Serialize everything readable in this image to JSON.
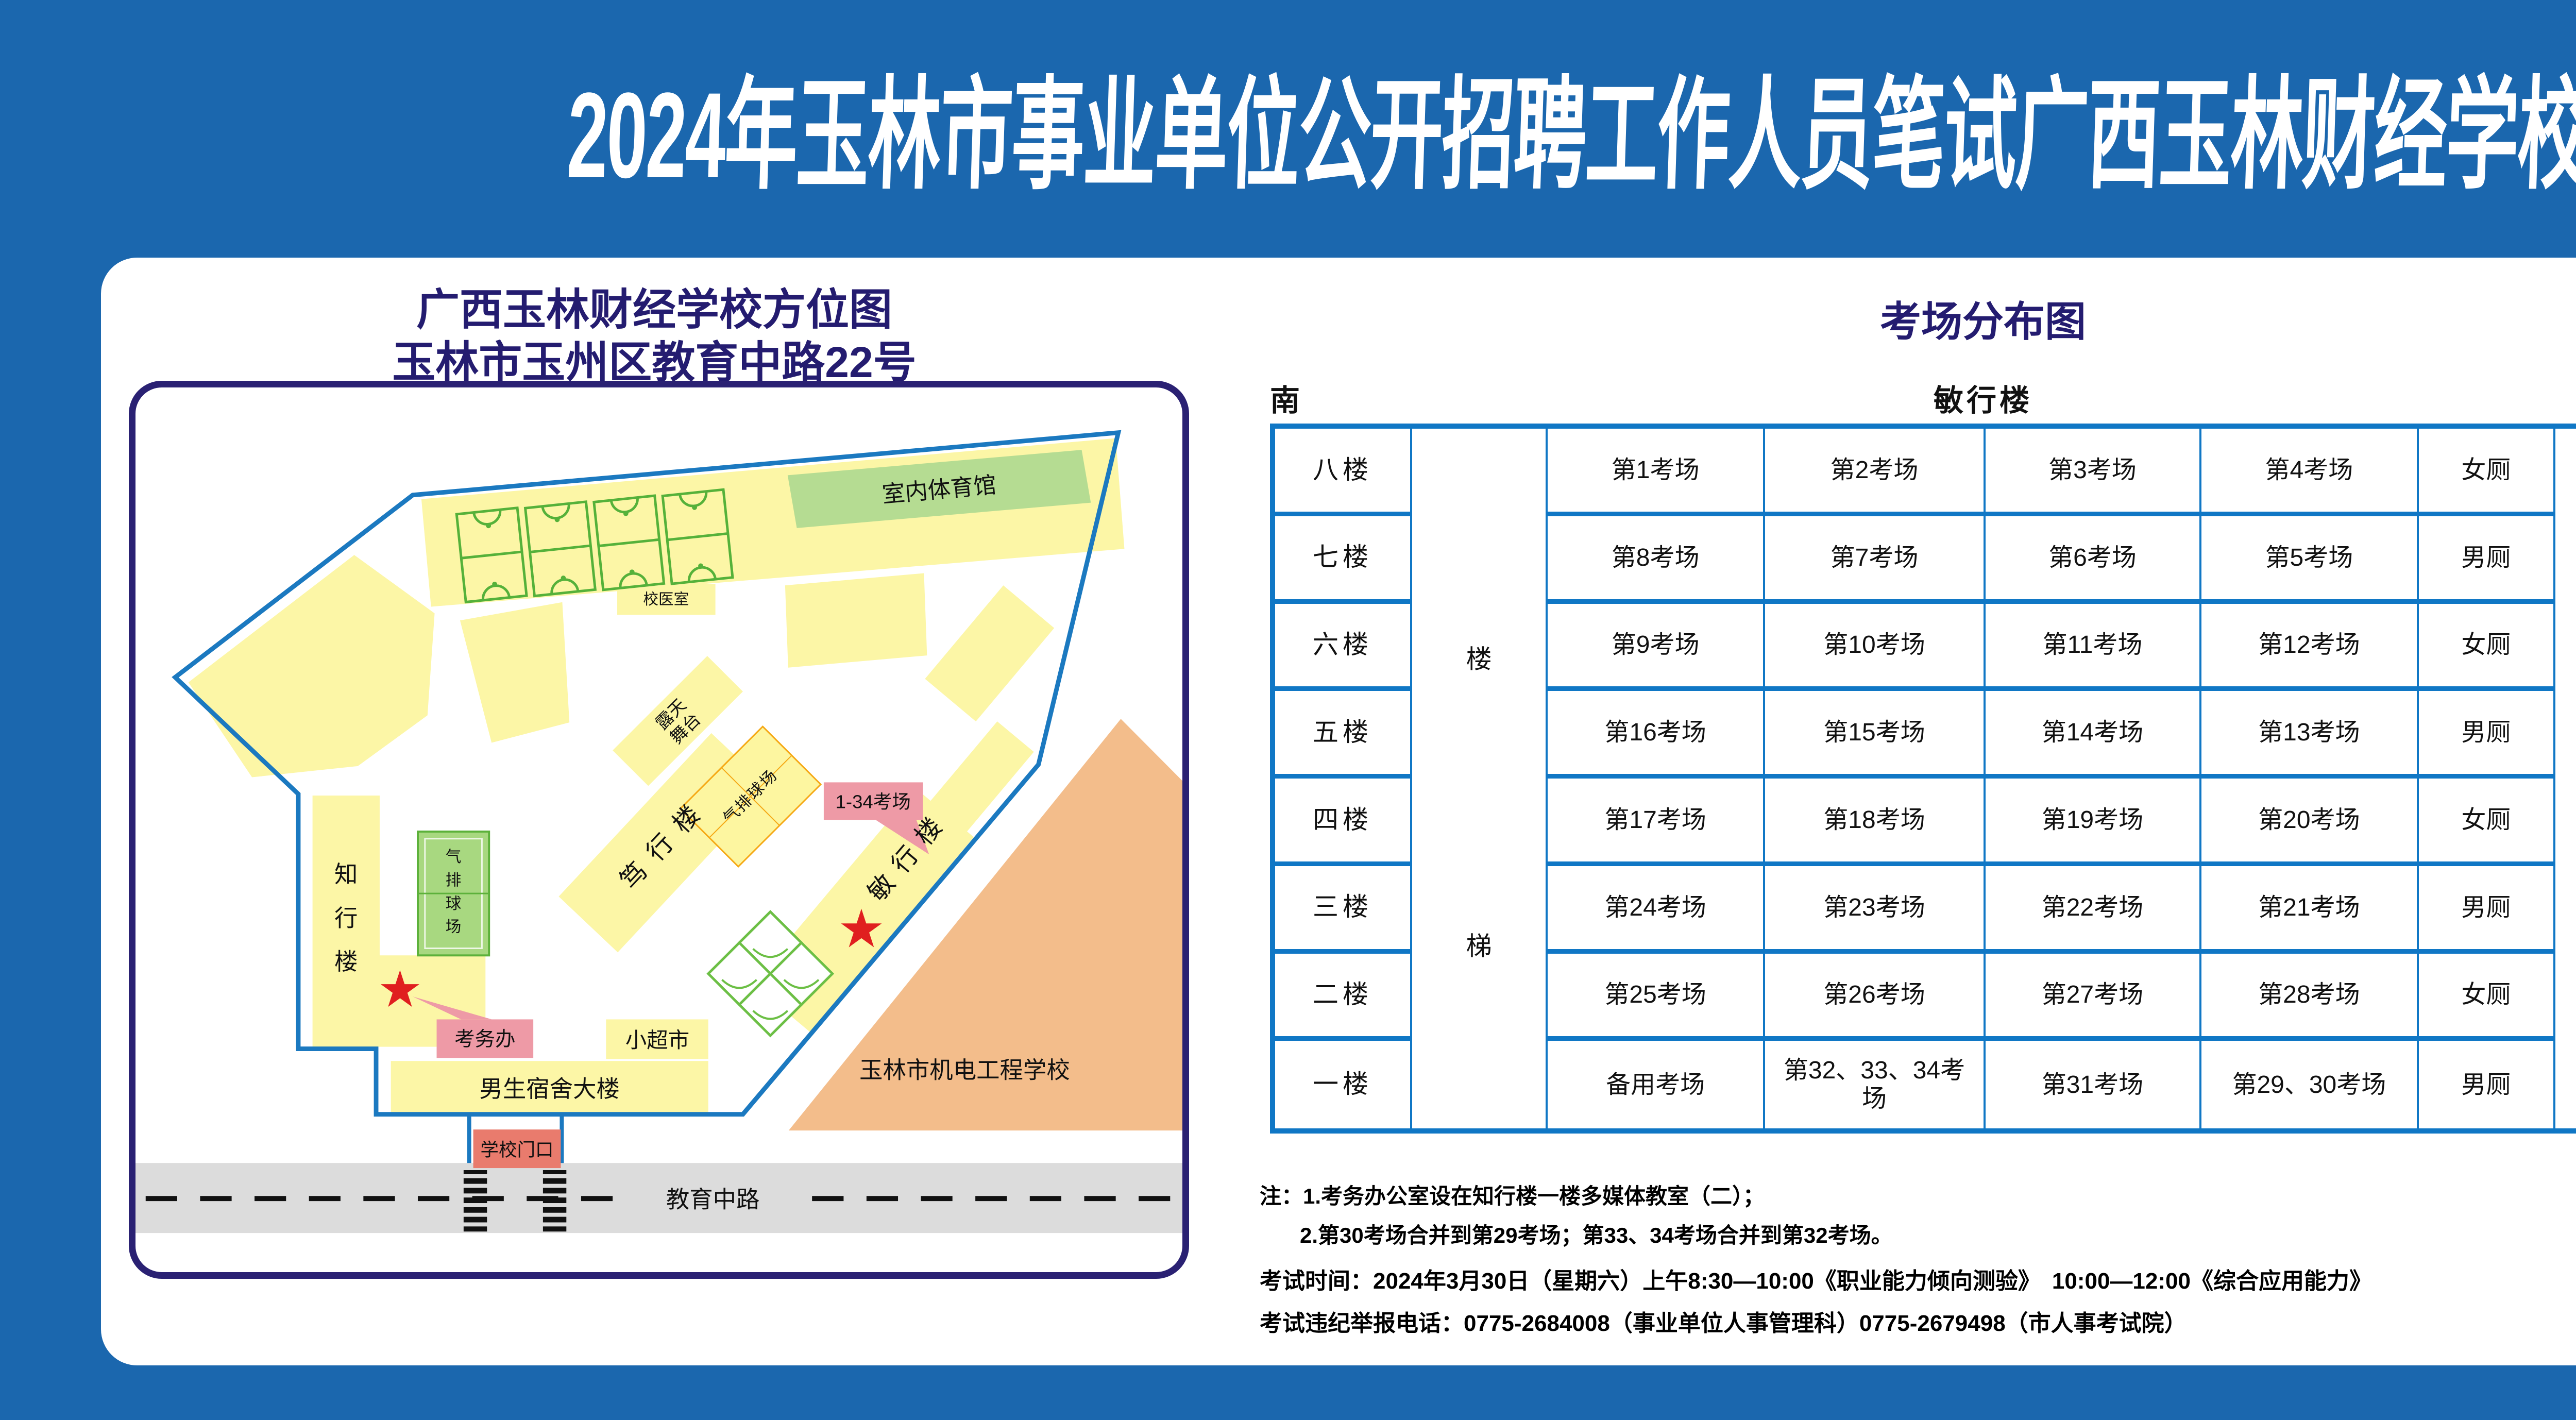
{
  "page": {
    "title": "2024年玉林市事业单位公开招聘工作人员笔试广西玉林财经学校考点考场示意图"
  },
  "colors": {
    "background": "#1b67ae",
    "navy_text": "#241c70",
    "grid_blue": "#1077c5",
    "boundary_blue": "#1b79c0",
    "building_yellow": "#fcf6a6",
    "gym_green": "#b5dc92",
    "court_green_fill": "#a8d880",
    "court_green_line": "#5cb13a",
    "court_orange_line": "#f5a814",
    "callout_pink": "#ee9aa6",
    "gate_salmon": "#e97b6d",
    "neighbor_orange": "#f3bd8b",
    "road_gray": "#dcdcdc",
    "star_red": "#e01f1f"
  },
  "map": {
    "title_line1": "广西玉林财经学校方位图",
    "title_line2": "玉林市玉州区教育中路22号",
    "labels": {
      "gym": "室内体育馆",
      "clinic": "校医室",
      "stage_line1": "露天",
      "stage_line2": "舞台",
      "duxing_building": "笃行楼",
      "air_volleyball_diag": "气排球场",
      "rooms_callout": "1-34考场",
      "minxing_building": "敏行楼",
      "zhixing_building": "知行楼",
      "air_volleyball_court": "气排球场",
      "exam_office": "考务办",
      "supermarket": "小超市",
      "dorm": "男生宿舍大楼",
      "school_gate": "学校门口",
      "road": "教育中路",
      "neighbor_school": "玉林市机电工程学校"
    }
  },
  "distribution": {
    "title": "考场分布图",
    "south": "南",
    "building_header": "敏行楼",
    "north": "北",
    "stairs": {
      "upper": "楼",
      "lower": "梯"
    },
    "rows": [
      {
        "floor": "八楼",
        "rooms": [
          "第1考场",
          "第2考场",
          "第3考场",
          "第4考场"
        ],
        "toilet": "女厕"
      },
      {
        "floor": "七楼",
        "rooms": [
          "第8考场",
          "第7考场",
          "第6考场",
          "第5考场"
        ],
        "toilet": "男厕"
      },
      {
        "floor": "六楼",
        "rooms": [
          "第9考场",
          "第10考场",
          "第11考场",
          "第12考场"
        ],
        "toilet": "女厕"
      },
      {
        "floor": "五楼",
        "rooms": [
          "第16考场",
          "第15考场",
          "第14考场",
          "第13考场"
        ],
        "toilet": "男厕"
      },
      {
        "floor": "四楼",
        "rooms": [
          "第17考场",
          "第18考场",
          "第19考场",
          "第20考场"
        ],
        "toilet": "女厕"
      },
      {
        "floor": "三楼",
        "rooms": [
          "第24考场",
          "第23考场",
          "第22考场",
          "第21考场"
        ],
        "toilet": "男厕"
      },
      {
        "floor": "二楼",
        "rooms": [
          "第25考场",
          "第26考场",
          "第27考场",
          "第28考场"
        ],
        "toilet": "女厕"
      },
      {
        "floor": "一楼",
        "rooms": [
          "备用考场",
          "第32、33、34考场",
          "第31考场",
          "第29、30考场"
        ],
        "toilet": "男厕"
      }
    ]
  },
  "notes": {
    "line1": "注：1.考务办公室设在知行楼一楼多媒体教室（二）；",
    "line2": "2.第30考场合并到第29考场；第33、34考场合并到第32考场。",
    "line3": "考试时间：2024年3月30日（星期六）上午8:30—10:00《职业能力倾向测验》　10:00—12:00《综合应用能力》",
    "line4": "考试违纪举报电话：0775-2684008（事业单位人事管理科）0775-2679498（市人事考试院）"
  }
}
